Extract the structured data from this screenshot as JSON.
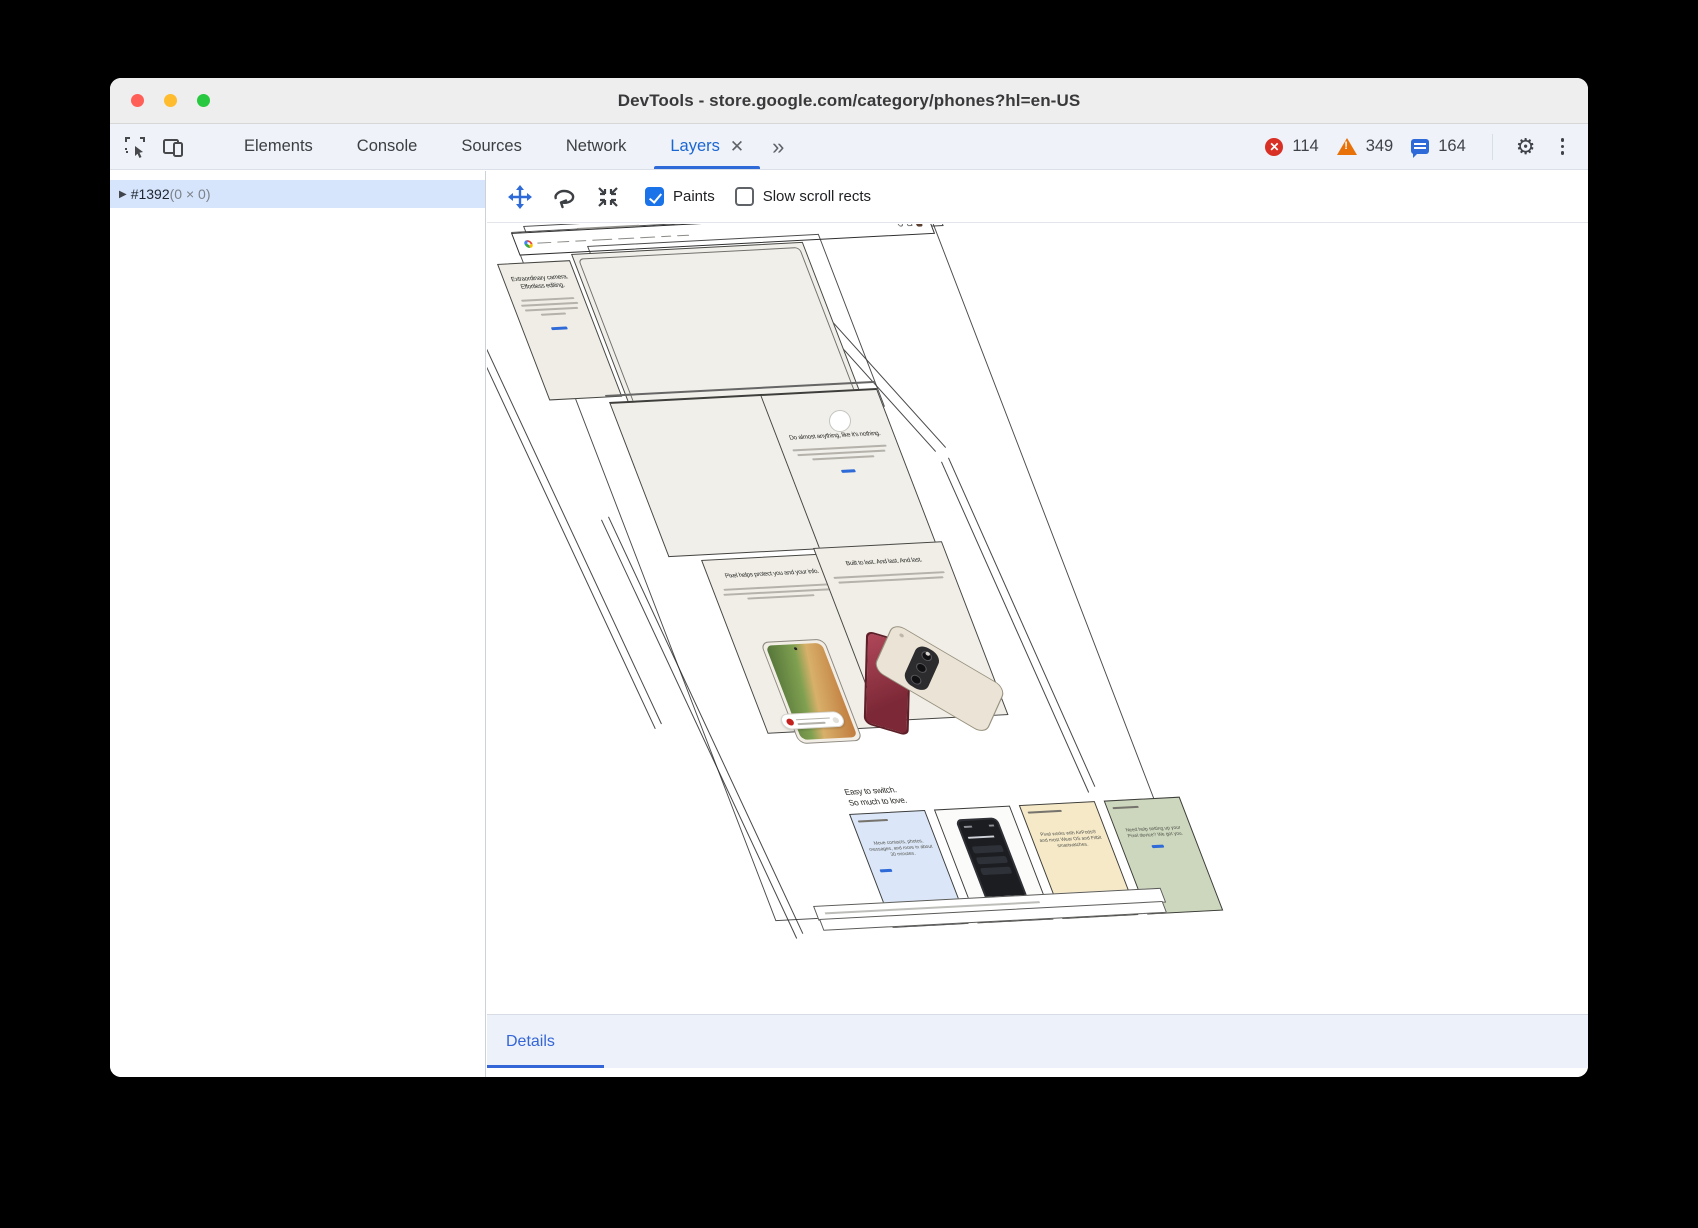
{
  "window": {
    "title": "DevTools - store.google.com/category/phones?hl=en-US"
  },
  "tabs": {
    "items": [
      "Elements",
      "Console",
      "Sources",
      "Network"
    ],
    "active": "Layers",
    "close_glyph": "✕",
    "more_glyph": "»"
  },
  "status": {
    "errors": "114",
    "warnings": "349",
    "messages": "164"
  },
  "sidebar": {
    "node_id": "#1392",
    "node_size": "(0 × 0)"
  },
  "layers_toolbar": {
    "paints_label": "Paints",
    "slow_scroll_label": "Slow scroll rects"
  },
  "details": {
    "tab_label": "Details"
  },
  "scene": {
    "hero": {
      "heading": "Extraordinary camera. Effortless editing."
    },
    "anything": {
      "heading": "Do almost anything, like it's nothing."
    },
    "protect": {
      "heading": "Pixel helps protect you and your info."
    },
    "built": {
      "heading": "Built to last. And last. And last."
    },
    "switch": {
      "heading_line1": "Easy to switch.",
      "heading_line2": "So much to love.",
      "cards": [
        {
          "body": "Move contacts, photos, messages, and more in about 30 minutes."
        },
        {
          "body": ""
        },
        {
          "body": "Pixel works with AirPods® and most Wear OS and Fitbit smartwatches."
        },
        {
          "body": "Need help setting up your Pixel device? We got you."
        }
      ]
    }
  },
  "colors": {
    "accent": "#1a73e8",
    "error": "#d93025",
    "warning": "#e8710a"
  }
}
